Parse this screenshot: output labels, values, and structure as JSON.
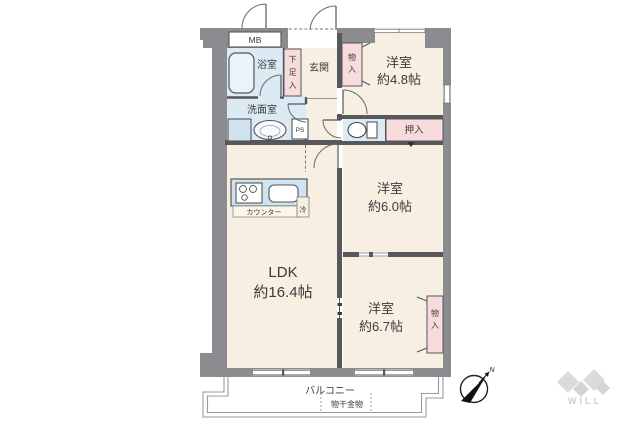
{
  "plan": {
    "meter_box": "MB",
    "bath": "浴室",
    "shoe_closet": "下足入",
    "entrance": "玄関",
    "closet_top": "物入",
    "room_small": {
      "name": "洋室",
      "size": "約4.8帖"
    },
    "washroom": "洗面室",
    "pipe_space": "PS",
    "oshiire": "押入",
    "room_mid": {
      "name": "洋室",
      "size": "約6.0帖"
    },
    "counter": "カウンター",
    "refrigerator": "冷",
    "ldk": {
      "name": "LDK",
      "size": "約16.4帖"
    },
    "room_large": {
      "name": "洋室",
      "size": "約6.7帖"
    },
    "closet_bottom": "物入",
    "balcony": "バルコニー",
    "laundry_fitting": "物干金物"
  },
  "compass": {
    "north": "N"
  },
  "brand": {
    "logo": "WILL"
  },
  "colors": {
    "wall_outer": "#8c8c90",
    "wall_inner": "#58585c",
    "room_beige": "#f6efe2",
    "wet_blue": "#dcebf3",
    "closet_pink": "#f8dcdd",
    "line": "#55555a",
    "balcony_line": "#9a9a9e",
    "logo_gray": "#d9d9d9"
  }
}
